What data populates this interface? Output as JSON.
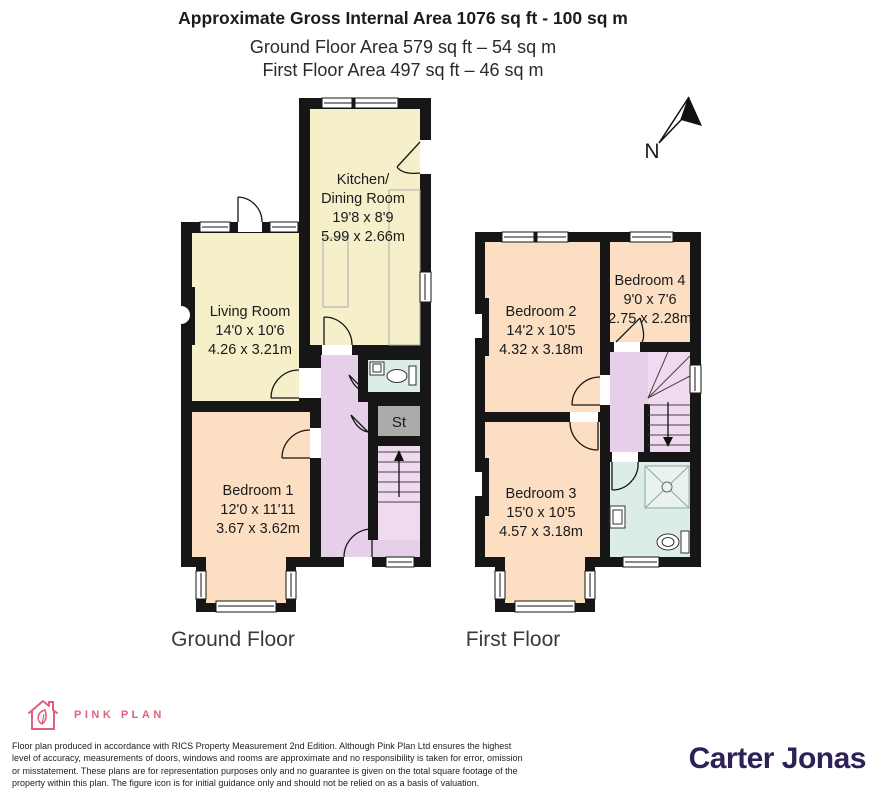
{
  "header": {
    "title": "Approximate Gross Internal Area 1076 sq ft - 100 sq m",
    "subtitle1": "Ground Floor Area 579 sq ft – 54 sq m",
    "subtitle2": "First Floor Area 497 sq ft – 46 sq m"
  },
  "compass": {
    "label": "N"
  },
  "ground_floor": {
    "label": "Ground Floor",
    "rooms": {
      "kitchen": {
        "name_line1": "Kitchen/",
        "name_line2": "Dining Room",
        "dims_imperial": "19'8 x 8'9",
        "dims_metric": "5.99 x 2.66m"
      },
      "living": {
        "name": "Living Room",
        "dims_imperial": "14'0 x 10'6",
        "dims_metric": "4.26 x 3.21m"
      },
      "bedroom1": {
        "name": "Bedroom 1",
        "dims_imperial": "12'0 x 11'11",
        "dims_metric": "3.67 x 3.62m"
      },
      "store": {
        "name": "St"
      }
    }
  },
  "first_floor": {
    "label": "First Floor",
    "rooms": {
      "bedroom2": {
        "name": "Bedroom 2",
        "dims_imperial": "14'2 x 10'5",
        "dims_metric": "4.32 x 3.18m"
      },
      "bedroom3": {
        "name": "Bedroom 3",
        "dims_imperial": "15'0 x 10'5",
        "dims_metric": "4.57 x 3.18m"
      },
      "bedroom4": {
        "name": "Bedroom 4",
        "dims_imperial": "9'0 x 7'6",
        "dims_metric": "2.75 x 2.28m"
      }
    }
  },
  "footer": {
    "brand": "PINK PLAN",
    "disclaimer_lines": [
      "Floor plan produced in accordance with RICS Property Measurement 2nd Edition. Although Pink Plan Ltd ensures the highest",
      "level of accuracy, measurements of doors, windows and rooms are approximate and no responsibility is taken for error, omission",
      "or misstatement. These plans are for representation purposes only and no guarantee is given on the total square footage of the",
      "property within this plan. The figure icon is for initial guidance only and should not be relied on as a basis of valuation."
    ],
    "agent": "Carter Jonas"
  },
  "colors": {
    "room_yellow": "#F5F0CA",
    "room_peach": "#FCDFC3",
    "hall_purple": "#E6CFE9",
    "stairs_pink": "#F0DAEF",
    "bath_blue": "#DCECE8",
    "store_grey": "#ABABAB",
    "wall_black": "#161616",
    "brand_pink": "#E0607C",
    "agent_purple": "#2E2158"
  }
}
